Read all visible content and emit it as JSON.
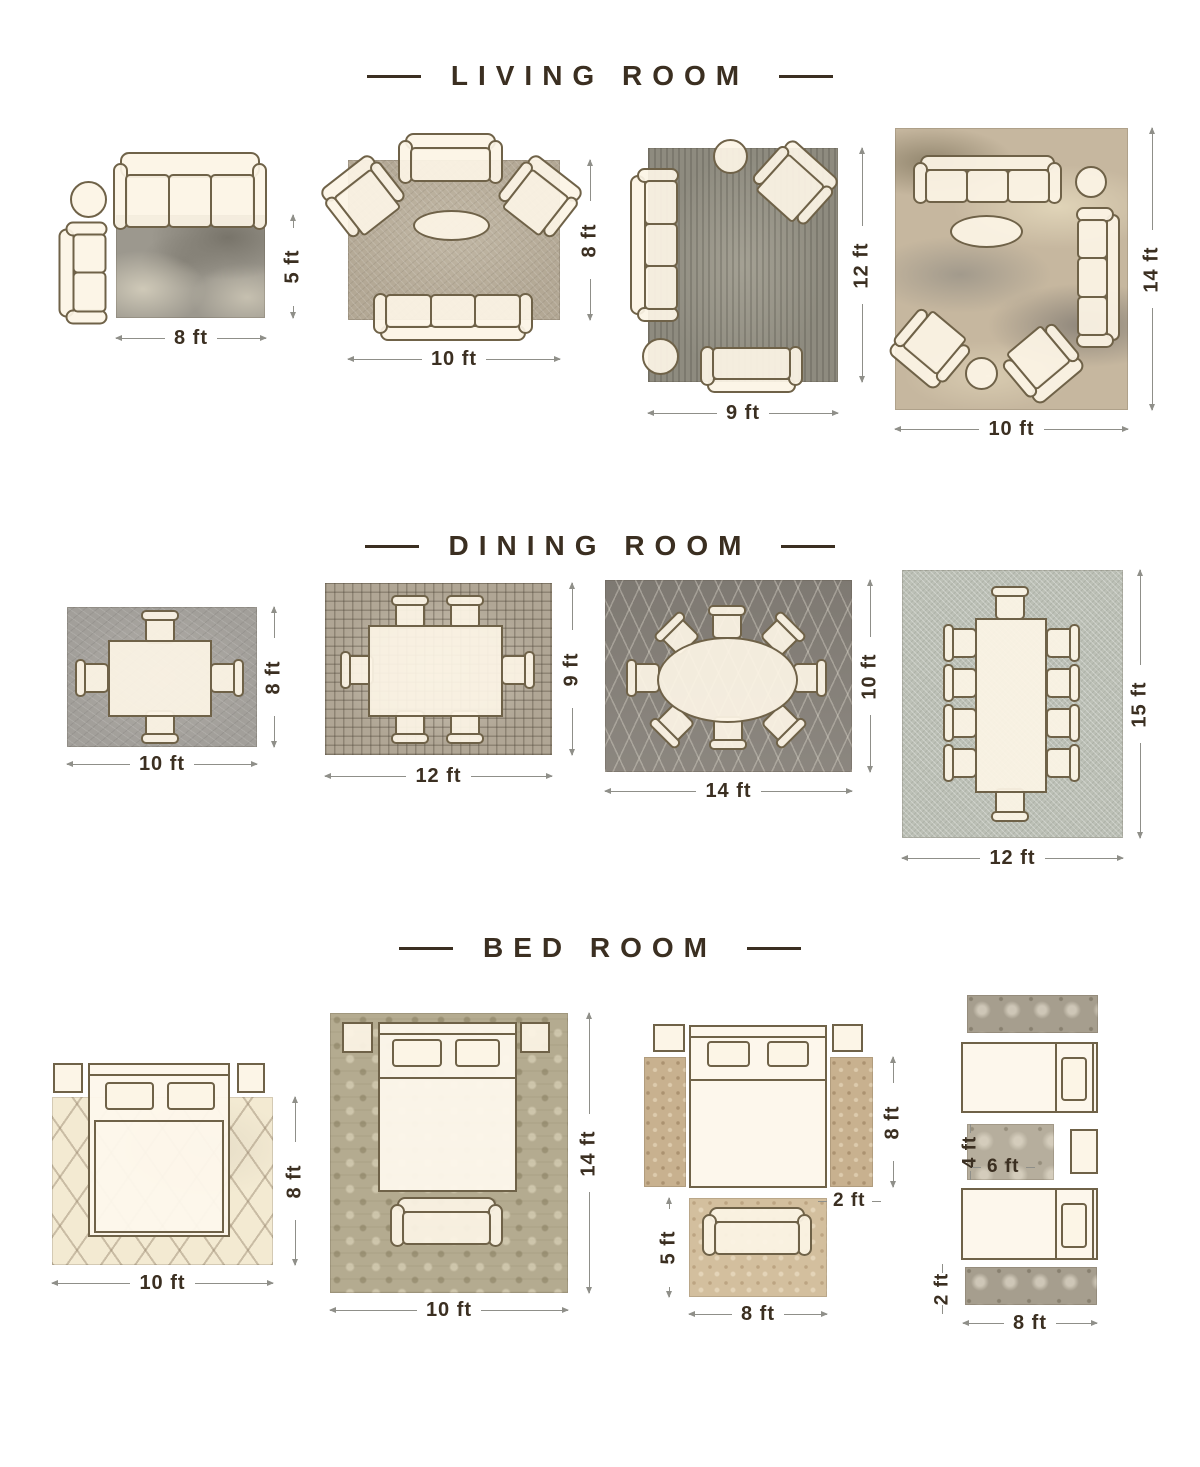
{
  "sections": [
    {
      "title": "LIVING ROOM",
      "layouts": [
        {
          "width": "8 ft",
          "height": "5 ft"
        },
        {
          "width": "10 ft",
          "height": "8 ft"
        },
        {
          "width": "9 ft",
          "height": "12 ft"
        },
        {
          "width": "10 ft",
          "height": "14 ft"
        }
      ]
    },
    {
      "title": "DINING ROOM",
      "layouts": [
        {
          "width": "10 ft",
          "height": "8 ft"
        },
        {
          "width": "12 ft",
          "height": "9 ft"
        },
        {
          "width": "14 ft",
          "height": "10 ft"
        },
        {
          "width": "12 ft",
          "height": "15 ft"
        }
      ]
    },
    {
      "title": "BED ROOM",
      "layouts": [
        {
          "width": "10 ft",
          "height": "8 ft"
        },
        {
          "width": "10 ft",
          "height": "14 ft"
        },
        {
          "side_runner_height": "8 ft",
          "side_runner_width": "2 ft",
          "foot_rug_height": "5 ft",
          "foot_rug_width": "8 ft"
        },
        {
          "between_rug_height": "4 ft",
          "between_rug_width": "6 ft",
          "foot_runner_height": "2 ft",
          "foot_runner_width": "8 ft"
        }
      ]
    }
  ],
  "palette": {
    "background": "#ffffff",
    "ink": "#3b2f21",
    "furniture_fill": "#fbf3e3",
    "furniture_outline": "#6f6248",
    "dimension_line": "#8f8f89"
  }
}
